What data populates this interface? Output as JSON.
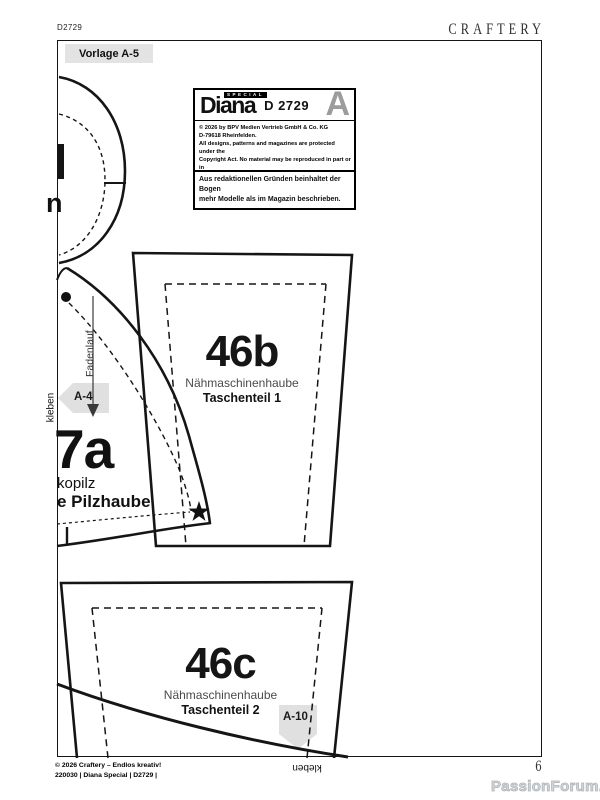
{
  "page": {
    "doc_code": "D2729",
    "brand": "CRAFTERY",
    "vorlage_label": "Vorlage A-5",
    "page_number": "6",
    "watermark": "PassionForum.ru"
  },
  "info_box": {
    "logo_name": "Diana",
    "logo_special": "SPECIAL",
    "model_code": "D 2729",
    "sheet_letter": "A",
    "copyright_lines": [
      "© 2026 by BPV Medien Vertrieb GmbH & Co. KG",
      "D-79618 Rheinfelden.",
      "All designs, patterns and magazines are protected under the",
      "Copyright Act. No material may be reproduced in part or in",
      "whole. All commercial and industrial use is strictly prohibited."
    ],
    "editorial_note_line1": "Aus redaktionellen Gründen beinhaltet der Bogen",
    "editorial_note_line2": "mehr Modelle als im Magazin beschrieben."
  },
  "pieces": {
    "p46b": {
      "number": "46b",
      "name": "Nähmaschinenhaube",
      "part": "Taschenteil 1"
    },
    "p46c": {
      "number": "46c",
      "name": "Nähmaschinenhaube",
      "part": "Taschenteil 2"
    },
    "p7a": {
      "number": "7a",
      "name_partial": "kopilz",
      "part_partial": "e Pilzhaube"
    }
  },
  "markers": {
    "grainline": "Fadenlauf",
    "a4": "A-4",
    "a10": "A-10",
    "glue_left": "kleben",
    "glue_bottom": "kleben",
    "partial_letter": "n"
  },
  "footer": {
    "line1": "© 2026 Craftery – Endlos kreativ!",
    "line2": "220030 | Diana Special | D2729 |"
  },
  "colors": {
    "line": "#151515",
    "sheet_letter_gray": "#9c9c9c",
    "marker_gray": "#e0e0e0",
    "watermark_gray": "#d3d7da"
  }
}
